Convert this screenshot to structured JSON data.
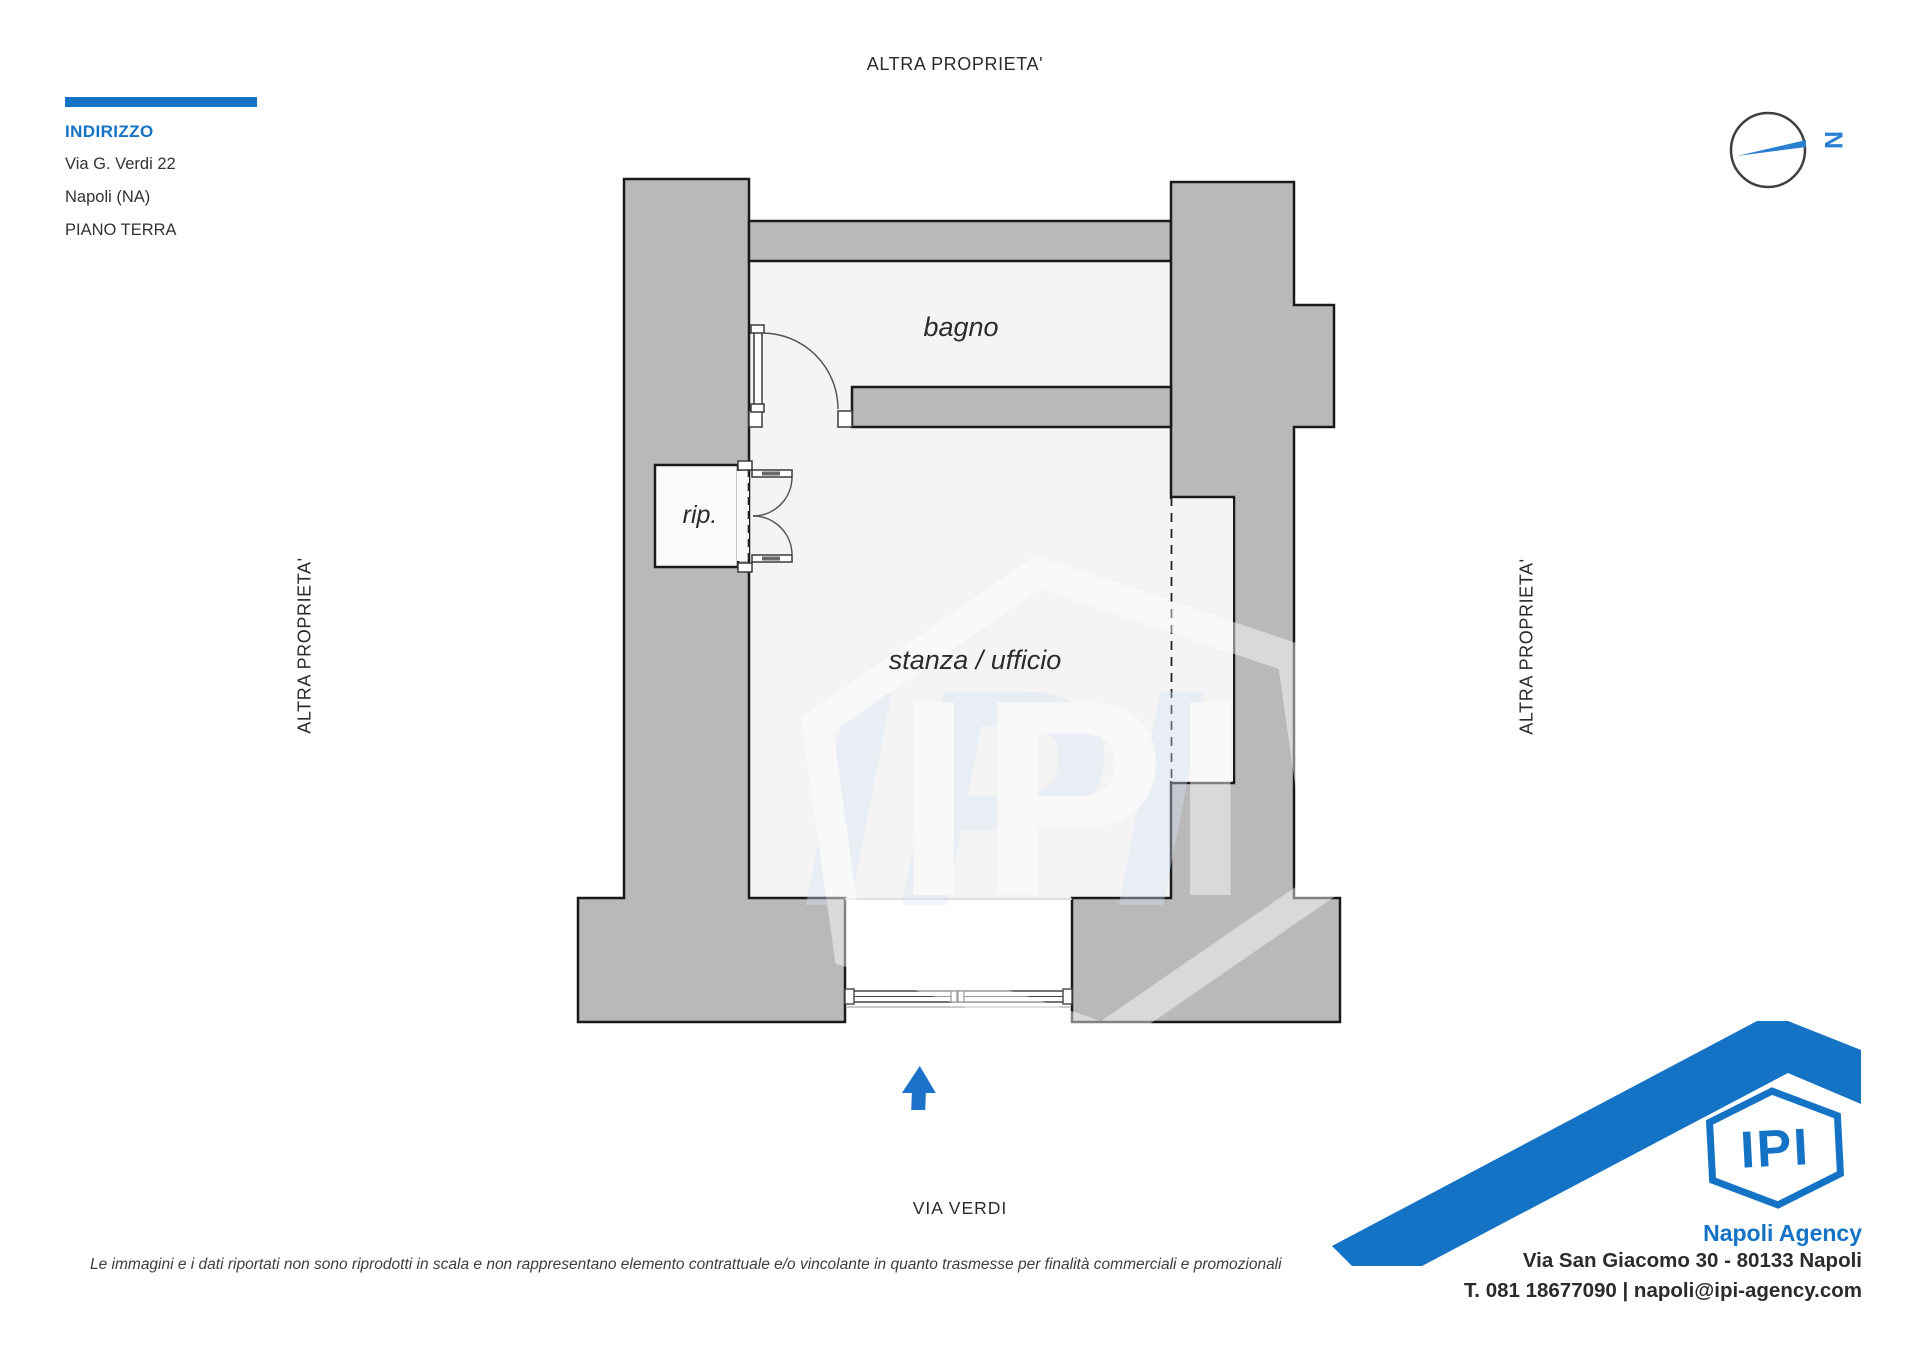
{
  "header": {
    "indirizzo_label": "INDIRIZZO",
    "address_line1": "Via G. Verdi 22",
    "address_line2": "Napoli (NA)",
    "floor_label": "PIANO TERRA"
  },
  "compass": {
    "north_label": "N"
  },
  "plan": {
    "boundary_label_top": "ALTRA PROPRIETA'",
    "boundary_label_left": "ALTRA PROPRIETA'",
    "boundary_label_right": "ALTRA PROPRIETA'",
    "street_label": "VIA VERDI",
    "rooms": [
      {
        "name": "bagno"
      },
      {
        "name": "rip."
      },
      {
        "name": "stanza / ufficio"
      }
    ]
  },
  "watermark_text": "IPI",
  "agency": {
    "logo_text": "IPI",
    "name": "Napoli Agency",
    "address": "Via San Giacomo 30 - 80133 Napoli",
    "contacts": "T. 081 18677090 | napoli@ipi-agency.com"
  },
  "footer": {
    "disclaimer": "Le immagini e i dati riportati non sono riprodotti in scala e non rappresentano elemento contrattuale e/o vincolante in quanto trasmesse per finalità commerciali e promozionali"
  },
  "colors": {
    "accent": "#1473c5",
    "wall_fill": "#b9b9b9",
    "wall_outline": "#1a1a1a",
    "floor": "#f4f4f4"
  }
}
